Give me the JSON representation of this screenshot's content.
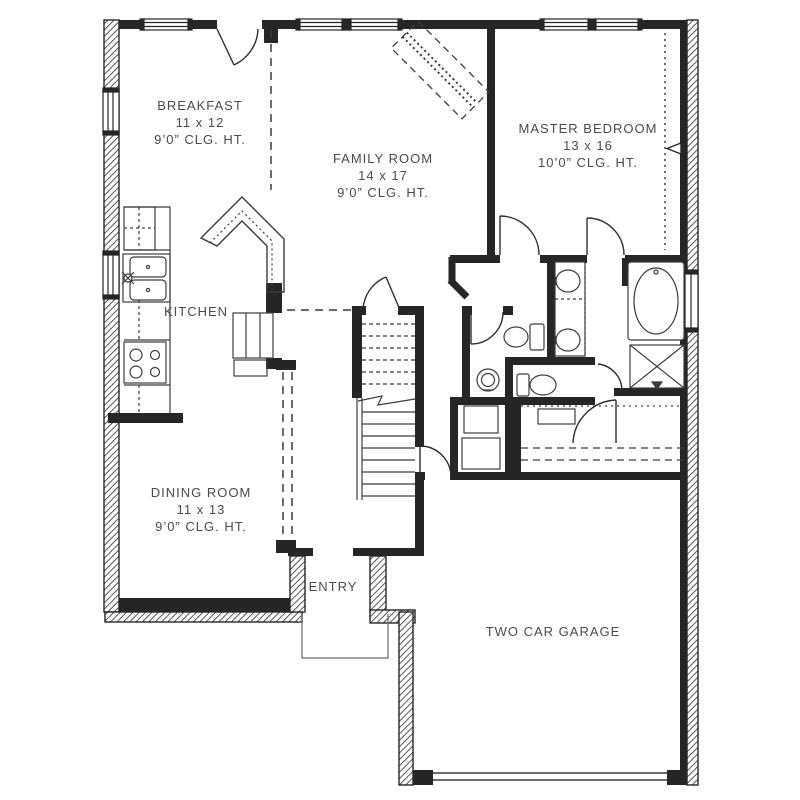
{
  "rooms": {
    "breakfast": {
      "name": "BREAKFAST",
      "size": "11 x 12",
      "ceiling": "9’0” CLG. HT."
    },
    "family_room": {
      "name": "FAMILY ROOM",
      "size": "14 x 17",
      "ceiling": "9’0” CLG. HT."
    },
    "master_bedroom": {
      "name": "MASTER BEDROOM",
      "size": "13 x 16",
      "ceiling": "10’0” CLG. HT."
    },
    "kitchen": {
      "name": "KITCHEN"
    },
    "dining_room": {
      "name": "DINING ROOM",
      "size": "11 x 13",
      "ceiling": "9’0” CLG. HT."
    },
    "entry": {
      "name": "ENTRY"
    },
    "garage": {
      "name": "TWO CAR GARAGE"
    }
  },
  "colors": {
    "background": "#ffffff",
    "walls": "#262626",
    "thin_lines": "#3c3c3c",
    "label_text": "#4a4a4a"
  }
}
